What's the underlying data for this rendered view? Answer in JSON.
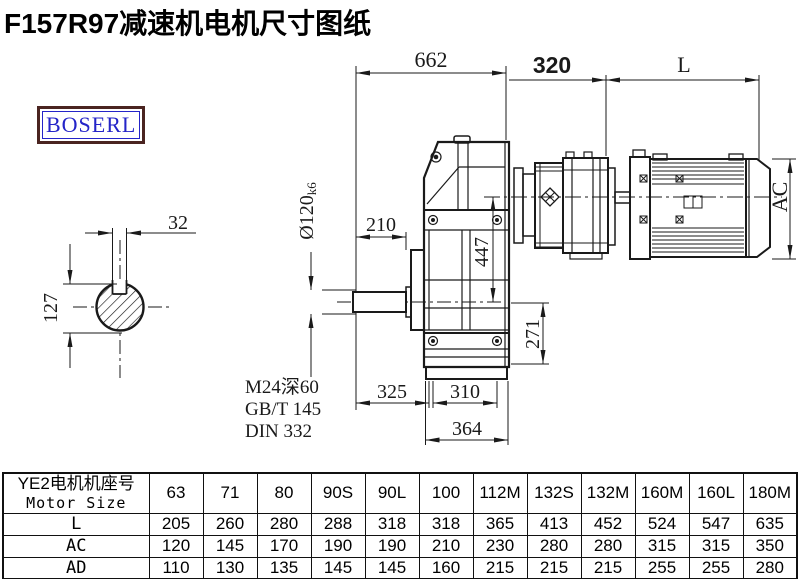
{
  "title": "F157R97减速机电机尺寸图纸",
  "logo": {
    "text": "BOSERL"
  },
  "colors": {
    "line": "#1a1a1a",
    "title": "#000000",
    "logo_border": "#4a2420",
    "logo_text": "#2424c8"
  },
  "drawing": {
    "dim_overall": "662",
    "dim_input": "320",
    "dim_motor_len": "L",
    "dim_keyway_width": "32",
    "dim_keyway_depth": "127",
    "dim_shaft_dia": "Ø120",
    "dim_shaft_tol": "k6",
    "dim_210": "210",
    "dim_447": "447",
    "dim_271": "271",
    "dim_325": "325",
    "dim_310": "310",
    "dim_364": "364",
    "dim_motor_height": "AC",
    "note_tap": "M24深60",
    "note_gb": "GB/T 145",
    "note_din": "DIN 332"
  },
  "table": {
    "header_cn": "YE2电机机座号",
    "header_en": "Motor Size",
    "columns": [
      "63",
      "71",
      "80",
      "90S",
      "90L",
      "100",
      "112M",
      "132S",
      "132M",
      "160M",
      "160L",
      "180M"
    ],
    "rows": [
      {
        "label": "L",
        "values": [
          "205",
          "260",
          "280",
          "288",
          "318",
          "318",
          "365",
          "413",
          "452",
          "524",
          "547",
          "635"
        ]
      },
      {
        "label": "AC",
        "values": [
          "120",
          "145",
          "170",
          "190",
          "190",
          "210",
          "230",
          "280",
          "280",
          "315",
          "315",
          "350"
        ]
      },
      {
        "label": "AD",
        "values": [
          "110",
          "130",
          "135",
          "145",
          "145",
          "160",
          "215",
          "215",
          "215",
          "255",
          "255",
          "280"
        ]
      }
    ]
  }
}
